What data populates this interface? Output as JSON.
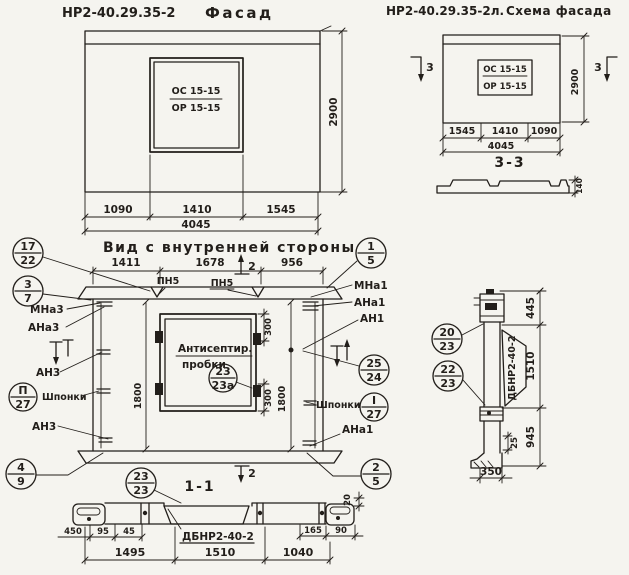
{
  "colors": {
    "ink": "#221e1a",
    "paper": "#f5f4ef"
  },
  "titles": {
    "facade_code": "НР2-40.29.35-2",
    "facade_word": "Фасад",
    "schema_code": "НР2-40.29.35-2л.",
    "schema_word": "Схема фасада",
    "inner_view": "Вид с внутренней стороны",
    "section_1_1": "1-1",
    "section_3_3": "3-3"
  },
  "facade": {
    "win_top": "ОС 15-15",
    "win_bot": "ОР 15-15",
    "d1": "1090",
    "d2": "1410",
    "d3": "1545",
    "total": "4045",
    "height": "2900"
  },
  "schema": {
    "win_top": "ОС 15-15",
    "win_bot": "ОР 15-15",
    "d1": "1545",
    "d2": "1410",
    "d3": "1090",
    "total": "4045",
    "height": "2900",
    "thickness": "140",
    "cut": "3"
  },
  "inner": {
    "d1": "1411",
    "d2": "1678",
    "d3": "956",
    "cut": "2",
    "h_left": "1800",
    "h_right": "1800",
    "win_dim_top": "300",
    "win_dim_bot": "300",
    "note1": "Антисептир.",
    "note2": "пробки",
    "pn": "ПН5",
    "labels": {
      "mna3": "МНа3",
      "ana3": "АНа3",
      "an3a": "АН3",
      "an3b": "АН3",
      "shponki_left": "Шпонки",
      "mna1": "МНа1",
      "ana1_top": "АНа1",
      "an1": "АН1",
      "shponki_right": "Шпонки",
      "ana1_bot": "АНа1"
    },
    "callouts": {
      "c17_22": {
        "top": "17",
        "bot": "22"
      },
      "c3_7": {
        "top": "3",
        "bot": "7"
      },
      "cII_27": {
        "top": "П",
        "bot": "27"
      },
      "c4_9": {
        "top": "4",
        "bot": "9"
      },
      "c1_5": {
        "top": "1",
        "bot": "5"
      },
      "c25_24": {
        "top": "25",
        "bot": "24"
      },
      "cI_27": {
        "top": "I",
        "bot": "27"
      },
      "c2_5": {
        "top": "2",
        "bot": "5"
      },
      "c23_23a": {
        "top": "23",
        "bot": "23а"
      },
      "c23_23": {
        "top": "23",
        "bot": "23"
      }
    }
  },
  "bottom_section": {
    "mark": "ДБНР2-40-2",
    "d450": "450",
    "d95": "95",
    "d45": "45",
    "d165": "165",
    "d90": "90",
    "d20": "20",
    "b1": "1495",
    "b2": "1510",
    "b3": "1040"
  },
  "side_section": {
    "mark": "ДБНР2-40-2",
    "d_top": "445",
    "d_mid": "1510",
    "d_bot": "945",
    "d_small": "25",
    "d_width": "350",
    "callouts": {
      "c20_23": {
        "top": "20",
        "bot": "23"
      },
      "c22_23": {
        "top": "22",
        "bot": "23"
      }
    }
  }
}
